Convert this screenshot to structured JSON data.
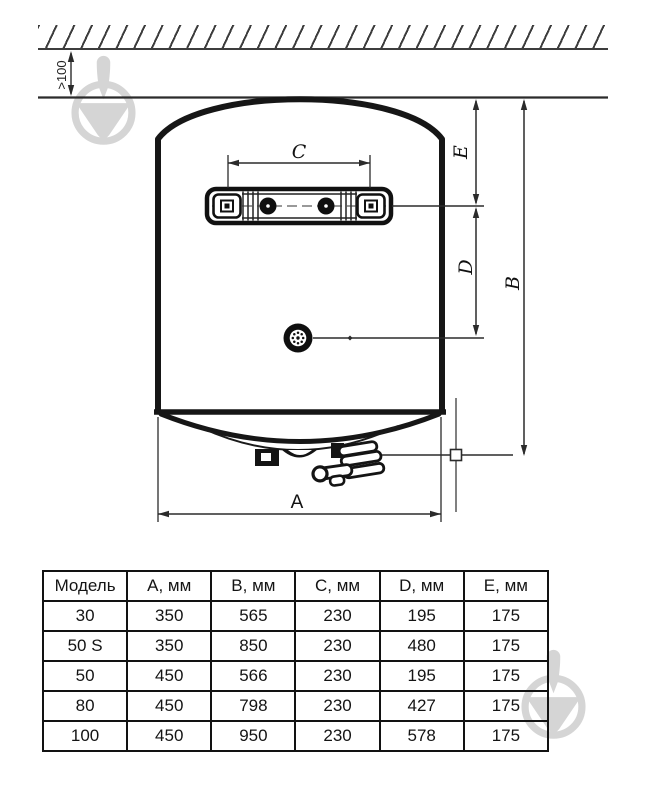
{
  "diagram": {
    "clearance_label": ">100",
    "labels": {
      "a": "A",
      "b": "B",
      "c": "C",
      "d": "D",
      "e": "E"
    }
  },
  "table": {
    "headers": [
      "Модель",
      "A, мм",
      "B, мм",
      "C, мм",
      "D, мм",
      "E, мм"
    ],
    "rows": [
      [
        "30",
        "350",
        "565",
        "230",
        "195",
        "175"
      ],
      [
        "50 S",
        "350",
        "850",
        "230",
        "480",
        "175"
      ],
      [
        "50",
        "450",
        "566",
        "230",
        "195",
        "175"
      ],
      [
        "80",
        "450",
        "798",
        "230",
        "427",
        "175"
      ],
      [
        "100",
        "450",
        "950",
        "230",
        "578",
        "175"
      ]
    ]
  },
  "colors": {
    "line": "#1a1a1a",
    "watermark": "#d5d5d5"
  }
}
